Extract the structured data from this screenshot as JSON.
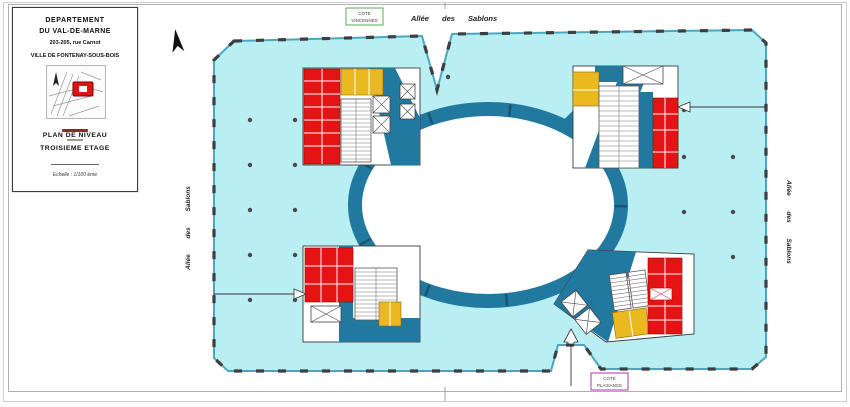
{
  "sheet": {
    "title_block": {
      "line1": "DEPARTEMENT",
      "line2": "DU VAL-DE-MARNE",
      "address": "203-205, rue Carnot",
      "city": "VILLE DE FONTENAY-SOUS-BOIS",
      "plan_title_1": "PLAN DE NIVEAU",
      "plan_title_2": "TROISIEME ETAGE",
      "scale": "Echelle : 1/100 ème"
    }
  },
  "plan": {
    "street_top": "Allée des Sablons",
    "street_left": "Allée des Sablons",
    "street_right": "Allée des Sablons",
    "marker_vincennes_line1": "COTE",
    "marker_vincennes_line2": "VINCENNES",
    "marker_plaisance_line1": "COTE",
    "marker_plaisance_line2": "PLAISANCE"
  },
  "colors": {
    "floor_cyan": "#b9eef3",
    "wall_teal": "#2179a0",
    "room_red": "#e41414",
    "room_yellow": "#eab91f",
    "mullion_dark": "#3e3e3e",
    "vincennes_border_green": "#55b055",
    "plaisance_border_magenta": "#b233b2"
  }
}
